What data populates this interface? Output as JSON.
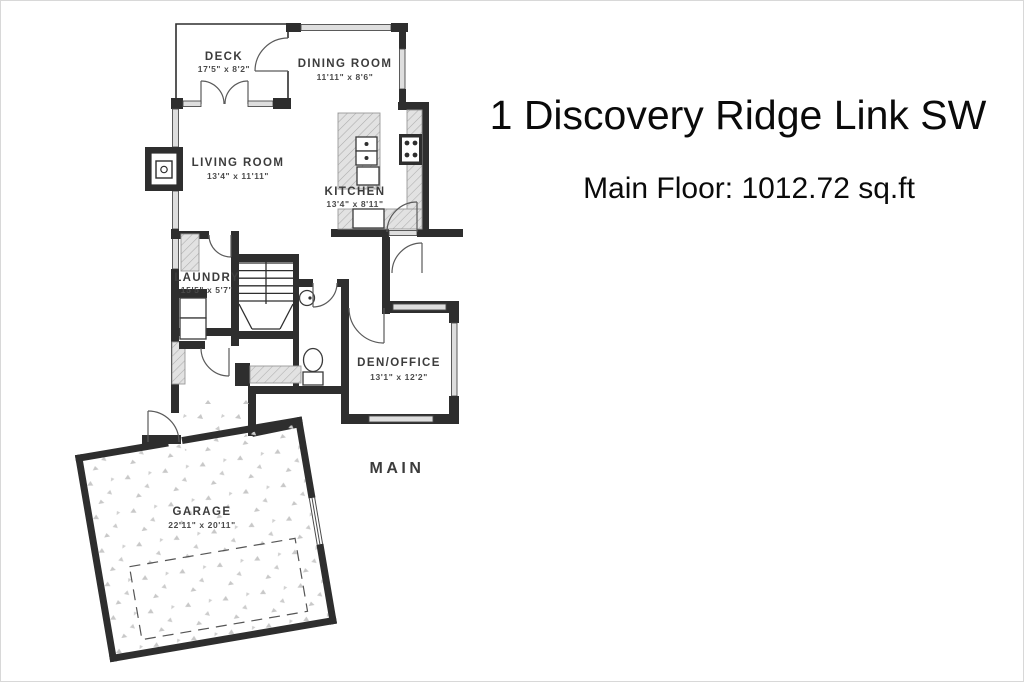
{
  "header": {
    "title": "1 Discovery Ridge Link SW",
    "subtitle": "Main Floor: 1012.72 sq.ft"
  },
  "floor_caption": "MAIN",
  "rooms": {
    "deck": {
      "name": "DECK",
      "dims": "17'5\" x 8'2\""
    },
    "dining": {
      "name": "DINING ROOM",
      "dims": "11'11\" x 8'6\""
    },
    "living": {
      "name": "LIVING ROOM",
      "dims": "13'4\" x 11'11\""
    },
    "kitchen": {
      "name": "KITCHEN",
      "dims": "13'4\" x 8'11\""
    },
    "laundry": {
      "name": "LAUNDRY",
      "dims": "15'5\" x 5'7\""
    },
    "den": {
      "name": "DEN/OFFICE",
      "dims": "13'1\" x 12'2\""
    },
    "garage": {
      "name": "GARAGE",
      "dims": "22'11\" x 20'11\""
    }
  },
  "colors": {
    "wall": "#2e2e2e",
    "window_fill": "#dedede",
    "counter_hatch": "#e2e2e2",
    "label_text": "#3c3c3c",
    "title_text": "#0a0a0a",
    "background": "#ffffff"
  }
}
